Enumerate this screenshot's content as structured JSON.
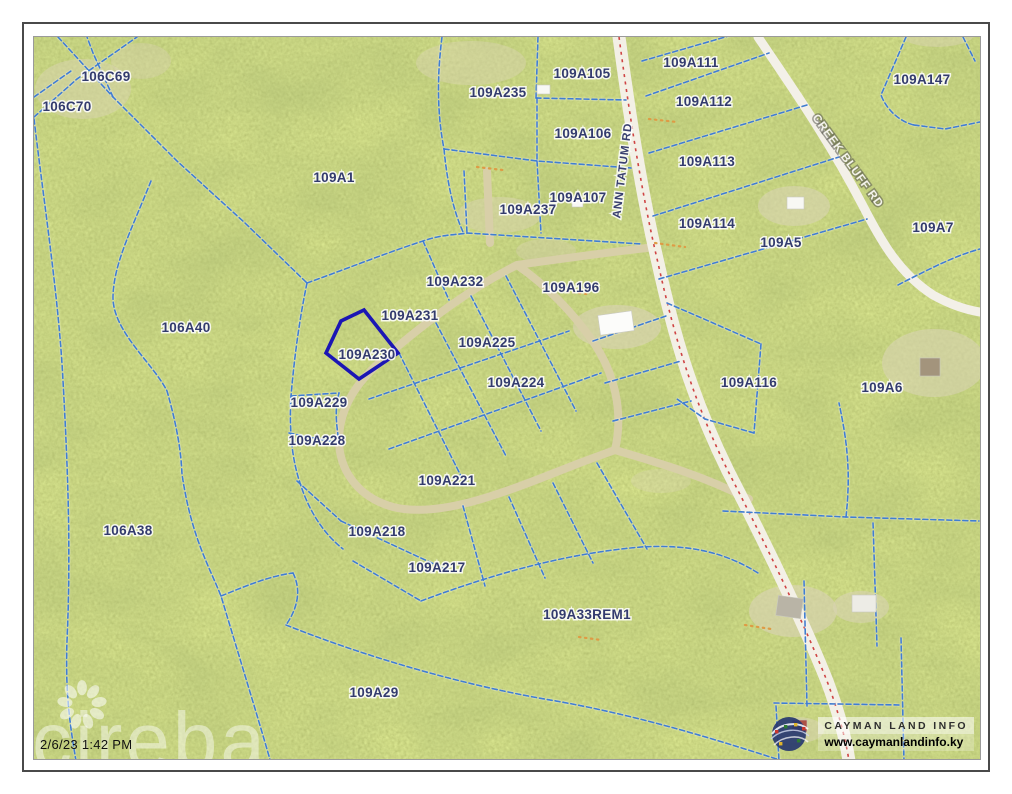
{
  "map": {
    "base_color": "#a3b259",
    "parcel_line_color": "#3f7fd0",
    "selected_outline_color": "#1b16b4",
    "main_road_centerline_color": "#cf4444",
    "label_color": "#333b6e"
  },
  "selected_parcel": "109A230",
  "parcels": [
    {
      "id": "106C69"
    },
    {
      "id": "106C70"
    },
    {
      "id": "109A1"
    },
    {
      "id": "106A40"
    },
    {
      "id": "109A235"
    },
    {
      "id": "109A105"
    },
    {
      "id": "109A106"
    },
    {
      "id": "109A107"
    },
    {
      "id": "109A237"
    },
    {
      "id": "109A111"
    },
    {
      "id": "109A112"
    },
    {
      "id": "109A113"
    },
    {
      "id": "109A114"
    },
    {
      "id": "109A5"
    },
    {
      "id": "109A147"
    },
    {
      "id": "109A7"
    },
    {
      "id": "109A232"
    },
    {
      "id": "109A196"
    },
    {
      "id": "109A231"
    },
    {
      "id": "109A230"
    },
    {
      "id": "109A225"
    },
    {
      "id": "109A224"
    },
    {
      "id": "109A116"
    },
    {
      "id": "109A6"
    },
    {
      "id": "109A229"
    },
    {
      "id": "109A228"
    },
    {
      "id": "109A221"
    },
    {
      "id": "109A218"
    },
    {
      "id": "109A217"
    },
    {
      "id": "106A38"
    },
    {
      "id": "109A33REM1"
    },
    {
      "id": "109A29"
    }
  ],
  "roads": [
    {
      "name": "ANN TATUM RD"
    },
    {
      "name": "CREEK BLUFF RD"
    }
  ],
  "annotations": {
    "timestamp": "2/6/23 1:42 PM",
    "watermark": "cireba"
  },
  "branding": {
    "logo_title": "CAYMAN LAND INFO",
    "logo_url": "www.caymanlandinfo.ky"
  }
}
